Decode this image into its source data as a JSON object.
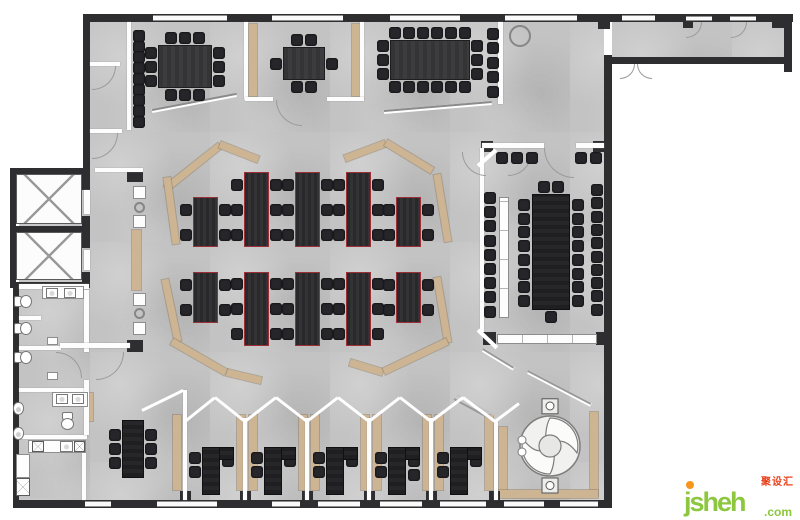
{
  "watermark": {
    "brand": "jsheh",
    "tld": ".com",
    "cjk": "聚设汇"
  },
  "palette": {
    "floor": "#c3c3c3",
    "wall_dark": "#2e2e30",
    "partition_white": "#fdfdfd",
    "accent_tan": "#cdb493",
    "desk": "#2e2e30",
    "desk_outline": "#9c2e35",
    "chair": "#26262a",
    "table": "#3a3a3c",
    "logo_green": "#8dc63f",
    "logo_orange": "#f7941d",
    "logo_red": "#e8401c"
  },
  "floorplan": {
    "canvas": {
      "w": 800,
      "h": 520
    },
    "floors": [
      [
        90,
        22,
        514,
        480
      ],
      [
        612,
        22,
        174,
        35
      ],
      [
        19,
        168,
        71,
        334
      ]
    ],
    "tan_boxes": [
      [
        249,
        24,
        8,
        72
      ],
      [
        352,
        24,
        8,
        72
      ],
      [
        132,
        230,
        9,
        60
      ],
      [
        86,
        393,
        7,
        28
      ],
      [
        173,
        415,
        8,
        75
      ],
      [
        237,
        415,
        8,
        75
      ],
      [
        249,
        415,
        8,
        75
      ],
      [
        299,
        415,
        8,
        75
      ],
      [
        311,
        415,
        8,
        75
      ],
      [
        361,
        415,
        8,
        75
      ],
      [
        373,
        415,
        8,
        75
      ],
      [
        423,
        415,
        8,
        75
      ],
      [
        435,
        415,
        8,
        75
      ],
      [
        485,
        415,
        8,
        75
      ],
      [
        499,
        427,
        8,
        66
      ],
      [
        590,
        412,
        8,
        84
      ],
      [
        499,
        490,
        99,
        8
      ]
    ],
    "tan_segs": [
      [
        166,
        188,
        220,
        145
      ],
      [
        220,
        144,
        258,
        159
      ],
      [
        167,
        177,
        176,
        243
      ],
      [
        165,
        279,
        178,
        341
      ],
      [
        172,
        341,
        226,
        372
      ],
      [
        227,
        372,
        261,
        380
      ],
      [
        345,
        158,
        385,
        143
      ],
      [
        386,
        142,
        432,
        170
      ],
      [
        437,
        174,
        448,
        241
      ],
      [
        437,
        277,
        448,
        342
      ],
      [
        350,
        362,
        383,
        372
      ],
      [
        384,
        371,
        447,
        341
      ]
    ],
    "walls": [
      [
        83,
        14,
        710,
        8
      ],
      [
        83,
        14,
        7,
        158
      ],
      [
        784,
        14,
        8,
        58
      ],
      [
        611,
        57,
        174,
        7
      ],
      [
        604,
        55,
        8,
        453
      ],
      [
        13,
        500,
        599,
        8
      ],
      [
        13,
        288,
        6,
        214
      ],
      [
        10,
        168,
        80,
        6
      ],
      [
        10,
        226,
        80,
        6
      ],
      [
        10,
        282,
        80,
        6
      ],
      [
        10,
        168,
        6,
        120
      ],
      [
        82,
        168,
        8,
        22
      ],
      [
        82,
        216,
        8,
        32
      ],
      [
        82,
        272,
        8,
        16
      ],
      [
        598,
        22,
        12,
        7
      ],
      [
        683,
        22,
        10,
        6
      ],
      [
        772,
        22,
        12,
        6
      ],
      [
        127,
        170,
        16,
        12
      ],
      [
        127,
        340,
        16,
        12
      ],
      [
        481,
        141,
        12,
        11
      ],
      [
        593,
        141,
        12,
        11
      ],
      [
        483,
        332,
        13,
        13
      ],
      [
        596,
        332,
        14,
        13
      ],
      [
        180,
        491,
        11,
        10
      ],
      [
        240,
        491,
        11,
        10
      ],
      [
        302,
        491,
        11,
        10
      ],
      [
        364,
        491,
        11,
        10
      ],
      [
        426,
        491,
        11,
        10
      ],
      [
        489,
        491,
        11,
        10
      ]
    ],
    "windows": [
      [
        153,
        15,
        74,
        6
      ],
      [
        272,
        15,
        71,
        6
      ],
      [
        390,
        15,
        70,
        6
      ],
      [
        505,
        15,
        72,
        6
      ],
      [
        622,
        15,
        33,
        6
      ],
      [
        686,
        16,
        26,
        5
      ],
      [
        730,
        16,
        26,
        5
      ],
      [
        85,
        501,
        26,
        6
      ],
      [
        157,
        501,
        60,
        6
      ],
      [
        272,
        501,
        28,
        6
      ],
      [
        318,
        501,
        42,
        6
      ],
      [
        380,
        501,
        42,
        6
      ],
      [
        440,
        501,
        46,
        6
      ],
      [
        504,
        501,
        40,
        6
      ],
      [
        560,
        501,
        38,
        6
      ]
    ],
    "partitions": [
      [
        127,
        22,
        4,
        108
      ],
      [
        90,
        62,
        30,
        4
      ],
      [
        90,
        129,
        32,
        4
      ],
      [
        95,
        168,
        48,
        4
      ],
      [
        244,
        22,
        4,
        78
      ],
      [
        360,
        22,
        4,
        78
      ],
      [
        245,
        97,
        28,
        4
      ],
      [
        327,
        97,
        37,
        4
      ],
      [
        498,
        22,
        5,
        82
      ],
      [
        482,
        143,
        62,
        5
      ],
      [
        576,
        143,
        28,
        5
      ],
      [
        480,
        148,
        4,
        184
      ],
      [
        494,
        420,
        4,
        80
      ],
      [
        19,
        284,
        70,
        5
      ],
      [
        19,
        316,
        22,
        4
      ],
      [
        19,
        346,
        42,
        4
      ],
      [
        19,
        388,
        70,
        4
      ],
      [
        19,
        435,
        68,
        4
      ],
      [
        84,
        290,
        5,
        62
      ],
      [
        84,
        380,
        5,
        55
      ],
      [
        82,
        452,
        4,
        48
      ],
      [
        60,
        343,
        70,
        5
      ],
      [
        183,
        390,
        4,
        110
      ],
      [
        243,
        418,
        4,
        82
      ],
      [
        305,
        418,
        4,
        82
      ],
      [
        367,
        418,
        4,
        82
      ],
      [
        429,
        418,
        4,
        82
      ],
      [
        84,
        190,
        6,
        24
      ],
      [
        84,
        250,
        6,
        20
      ]
    ],
    "credenzas": [
      [
        497,
        334,
        100,
        10
      ],
      [
        499,
        197,
        10,
        121
      ]
    ],
    "lines": [
      [
        152,
        111,
        236,
        95,
        4,
        "#ffffff"
      ],
      [
        152,
        110,
        236,
        94,
        1.5,
        "#8b8b8b"
      ],
      [
        384,
        112,
        492,
        103,
        4,
        "#ffffff"
      ],
      [
        384,
        111,
        492,
        102,
        1.5,
        "#8b8b8b"
      ],
      [
        478,
        166,
        496,
        150,
        4,
        "#ffffff"
      ],
      [
        478,
        330,
        497,
        348,
        4,
        "#ffffff"
      ],
      [
        483,
        350,
        514,
        369,
        4,
        "#ffffff"
      ],
      [
        483,
        349,
        514,
        368,
        1.5,
        "#999999"
      ],
      [
        528,
        372,
        591,
        405,
        4,
        "#ffffff"
      ],
      [
        528,
        371,
        591,
        404,
        1.5,
        "#999999"
      ],
      [
        454,
        399,
        491,
        419,
        2,
        "#9a9a9a"
      ],
      [
        457,
        395,
        494,
        415,
        2,
        "#c2c2c2"
      ],
      [
        142,
        410,
        183,
        390,
        3,
        "#ffffff"
      ],
      [
        185,
        421,
        215,
        397,
        3,
        "#ffffff"
      ],
      [
        215,
        397,
        245,
        421,
        3,
        "#ffffff"
      ],
      [
        245,
        421,
        276,
        397,
        3,
        "#ffffff"
      ],
      [
        276,
        397,
        307,
        421,
        3,
        "#ffffff"
      ],
      [
        307,
        421,
        338,
        397,
        3,
        "#ffffff"
      ],
      [
        338,
        397,
        369,
        421,
        3,
        "#ffffff"
      ],
      [
        369,
        421,
        400,
        397,
        3,
        "#ffffff"
      ],
      [
        400,
        397,
        431,
        421,
        3,
        "#ffffff"
      ],
      [
        431,
        421,
        463,
        397,
        3,
        "#ffffff"
      ],
      [
        463,
        397,
        495,
        421,
        3,
        "#ffffff"
      ],
      [
        495,
        421,
        519,
        403,
        3,
        "#ffffff"
      ]
    ],
    "arcs": [
      [
        92,
        66,
        24,
        "br"
      ],
      [
        92,
        133,
        26,
        "br"
      ],
      [
        276,
        100,
        26,
        "bl"
      ],
      [
        544,
        148,
        30,
        "bl"
      ],
      [
        620,
        64,
        15,
        "br"
      ],
      [
        637,
        64,
        15,
        "bl"
      ],
      [
        686,
        22,
        16,
        "br"
      ],
      [
        731,
        22,
        16,
        "br"
      ],
      [
        56,
        352,
        26,
        "tr"
      ],
      [
        96,
        352,
        28,
        "br"
      ],
      [
        462,
        152,
        24,
        "bl"
      ],
      [
        508,
        152,
        24,
        "br"
      ]
    ],
    "chair_runs": [
      {
        "x": 133,
        "y": 30,
        "n": 9,
        "dx": 0,
        "dy": 10.7
      },
      {
        "x": 487,
        "y": 28,
        "n": 5,
        "dx": 0,
        "dy": 14.4
      },
      {
        "x": 484,
        "y": 192,
        "n": 9,
        "dx": 0,
        "dy": 14.2
      },
      {
        "x": 518,
        "y": 199,
        "n": 8,
        "dx": 0,
        "dy": 13.7
      },
      {
        "x": 572,
        "y": 199,
        "n": 8,
        "dx": 0,
        "dy": 13.7
      },
      {
        "x": 591,
        "y": 184,
        "n": 10,
        "dx": 0,
        "dy": 13.3
      },
      {
        "x": 496,
        "y": 152,
        "n": 3,
        "dx": 15,
        "dy": 0
      },
      {
        "x": 575,
        "y": 152,
        "n": 2,
        "dx": 15,
        "dy": 0
      }
    ],
    "tables": [
      {
        "x": 158,
        "y": 45,
        "w": 54,
        "h": 43,
        "t": 3,
        "b": 3,
        "l": 3,
        "r": 3,
        "cls": "tableA",
        "name": "meeting-table-west"
      },
      {
        "x": 283,
        "y": 47,
        "w": 42,
        "h": 33,
        "t": 2,
        "b": 2,
        "l": 1,
        "r": 1,
        "cls": "tableA",
        "name": "meeting-table-small"
      },
      {
        "x": 390,
        "y": 40,
        "w": 80,
        "h": 40,
        "t": 6,
        "b": 6,
        "l": 3,
        "r": 3,
        "cls": "tableA",
        "name": "meeting-table-north"
      },
      {
        "x": 532,
        "y": 194,
        "w": 38,
        "h": 116,
        "t": 2,
        "b": 1,
        "l": 0,
        "r": 0,
        "cls": "tableDark",
        "name": "boardroom-table"
      },
      {
        "x": 122,
        "y": 420,
        "w": 22,
        "h": 58,
        "t": 0,
        "b": 0,
        "l": 3,
        "r": 3,
        "cls": "tableDark",
        "name": "team-table-southwest"
      }
    ],
    "open_desks": [
      [
        193,
        197,
        25,
        50,
        2
      ],
      [
        244,
        172,
        25,
        75,
        3
      ],
      [
        295,
        172,
        25,
        75,
        3
      ],
      [
        346,
        172,
        25,
        75,
        3
      ],
      [
        396,
        197,
        25,
        50,
        2
      ],
      [
        193,
        272,
        25,
        51,
        2
      ],
      [
        244,
        272,
        25,
        74,
        3
      ],
      [
        295,
        272,
        25,
        74,
        3
      ],
      [
        346,
        272,
        25,
        74,
        3
      ],
      [
        396,
        272,
        25,
        51,
        2
      ]
    ],
    "offices": [
      {
        "x": 188,
        "rc": 1
      },
      {
        "x": 250,
        "rc": 1
      },
      {
        "x": 312,
        "rc": 1
      },
      {
        "x": 374,
        "rc": 2
      },
      {
        "x": 436,
        "rc": 1
      }
    ],
    "boxes": [
      {
        "c": "xbox",
        "x": 16,
        "y": 174,
        "w": 66,
        "h": 50,
        "n": "elevator-icon"
      },
      {
        "c": "xbox",
        "x": 16,
        "y": 232,
        "w": 66,
        "h": 48,
        "n": "elevator-icon"
      },
      {
        "c": "circb",
        "x": 509,
        "y": 25,
        "w": 22,
        "h": 22,
        "n": "plant-icon"
      },
      {
        "c": "counter",
        "x": 133,
        "y": 186,
        "w": 13,
        "h": 13,
        "n": "copier"
      },
      {
        "c": "counter",
        "x": 133,
        "y": 215,
        "w": 13,
        "h": 13,
        "n": "copier"
      },
      {
        "c": "circb",
        "x": 134,
        "y": 202,
        "w": 11,
        "h": 11,
        "n": "waste-bin-icon"
      },
      {
        "c": "counter",
        "x": 133,
        "y": 293,
        "w": 13,
        "h": 13,
        "n": "copier"
      },
      {
        "c": "counter",
        "x": 133,
        "y": 322,
        "w": 13,
        "h": 13,
        "n": "copier"
      },
      {
        "c": "circb",
        "x": 134,
        "y": 308,
        "w": 11,
        "h": 11,
        "n": "waste-bin-icon"
      },
      {
        "c": "counter",
        "x": 42,
        "y": 286,
        "w": 42,
        "h": 13,
        "n": "vanity-counter"
      },
      {
        "c": "sink",
        "x": 46,
        "y": 288,
        "w": 12,
        "h": 10,
        "n": "sink-icon"
      },
      {
        "c": "sink",
        "x": 64,
        "y": 288,
        "w": 12,
        "h": 10,
        "n": "sink-icon"
      },
      {
        "c": "toilet",
        "x": 14,
        "y": 294,
        "w": 17,
        "h": 13,
        "n": "toilet-icon"
      },
      {
        "c": "toilet",
        "x": 14,
        "y": 321,
        "w": 17,
        "h": 13,
        "n": "toilet-icon"
      },
      {
        "c": "toilet",
        "x": 14,
        "y": 350,
        "w": 17,
        "h": 13,
        "n": "toilet-icon"
      },
      {
        "c": "counter",
        "x": 47,
        "y": 337,
        "w": 11,
        "h": 8,
        "n": "fixture"
      },
      {
        "c": "counter",
        "x": 47,
        "y": 372,
        "w": 11,
        "h": 8,
        "n": "fixture"
      },
      {
        "c": "counter",
        "x": 52,
        "y": 392,
        "w": 36,
        "h": 15,
        "n": "vanity-counter"
      },
      {
        "c": "sink",
        "x": 56,
        "y": 394,
        "w": 12,
        "h": 10,
        "n": "sink-icon"
      },
      {
        "c": "sink",
        "x": 72,
        "y": 394,
        "w": 12,
        "h": 10,
        "n": "sink-icon"
      },
      {
        "c": "toilet",
        "x": 60,
        "y": 414,
        "w": 17,
        "h": 13,
        "r": 90,
        "n": "toilet-icon"
      },
      {
        "c": "urinal",
        "x": 13,
        "y": 402,
        "w": 11,
        "h": 13,
        "n": "urinal-icon"
      },
      {
        "c": "urinal",
        "x": 13,
        "y": 427,
        "w": 11,
        "h": 13,
        "n": "urinal-icon"
      },
      {
        "c": "counter",
        "x": 28,
        "y": 440,
        "w": 58,
        "h": 13,
        "n": "kitchen-counter"
      },
      {
        "c": "xbox",
        "x": 32,
        "y": 441,
        "w": 12,
        "h": 11,
        "n": "cooktop-icon"
      },
      {
        "c": "sink",
        "x": 60,
        "y": 441,
        "w": 13,
        "h": 11,
        "n": "kitchen-sink-icon"
      },
      {
        "c": "xbox",
        "x": 74,
        "y": 441,
        "w": 11,
        "h": 11,
        "n": "appliance-icon"
      },
      {
        "c": "counter",
        "x": 16,
        "y": 454,
        "w": 14,
        "h": 24,
        "n": "cabinet"
      },
      {
        "c": "xbox",
        "x": 16,
        "y": 478,
        "w": 14,
        "h": 18,
        "n": "appliance-icon"
      }
    ]
  }
}
